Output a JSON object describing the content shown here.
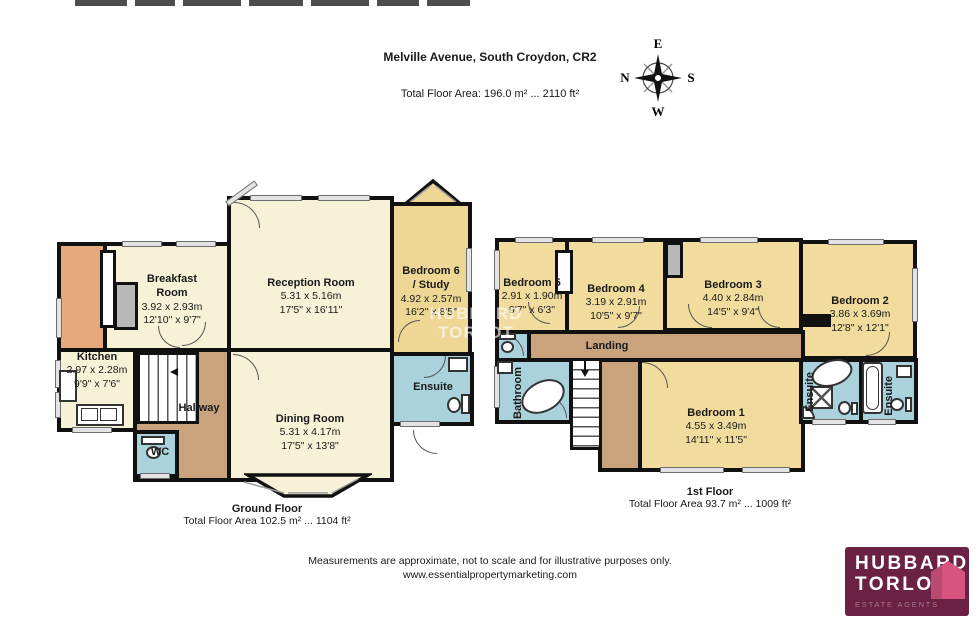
{
  "header": {
    "title": "Melville Avenue, South Croydon, CR2",
    "total_area": "Total Floor Area: 196.0 m² ... 2110 ft²"
  },
  "compass": {
    "top": "E",
    "left": "N",
    "right": "S",
    "bottom": "W"
  },
  "watermark": {
    "line1": "HUBBARD",
    "line2": "TORLOT"
  },
  "ground_floor": {
    "title": "Ground Floor",
    "area": "Total Floor Area 102.5 m² ... 1104 ft²",
    "rooms": {
      "breakfast": {
        "name": "Breakfast Room",
        "metric": "3.92 x 2.93m",
        "imperial": "12'10\" x 9'7\""
      },
      "reception": {
        "name": "Reception Room",
        "metric": "5.31 x 5.16m",
        "imperial": "17'5\" x 16'11\""
      },
      "bedroom6": {
        "name": "Bedroom 6",
        "name2": "/ Study",
        "metric": "4.92 x 2.57m",
        "imperial": "16'2\" x 8'5\""
      },
      "kitchen": {
        "name": "Kitchen",
        "metric": "2.97 x 2.28m",
        "imperial": "9'9\" x 7'6\""
      },
      "dining": {
        "name": "Dining Room",
        "metric": "5.31 x 4.17m",
        "imperial": "17'5\" x 13'8\""
      },
      "hallway": {
        "name": "Hallway"
      },
      "wc": {
        "name": "WC"
      },
      "ensuite": {
        "name": "Ensuite"
      }
    }
  },
  "first_floor": {
    "title": "1st Floor",
    "area": "Total Floor Area 93.7 m² ... 1009 ft²",
    "rooms": {
      "bedroom1": {
        "name": "Bedroom 1",
        "metric": "4.55 x 3.49m",
        "imperial": "14'11\" x 11'5\""
      },
      "bedroom2": {
        "name": "Bedroom 2",
        "metric": "3.86 x 3.69m",
        "imperial": "12'8\" x 12'1\""
      },
      "bedroom3": {
        "name": "Bedroom 3",
        "metric": "4.40 x 2.84m",
        "imperial": "14'5\" x 9'4\""
      },
      "bedroom4": {
        "name": "Bedroom 4",
        "metric": "3.19 x 2.91m",
        "imperial": "10'5\" x 9'7\""
      },
      "bedroom5": {
        "name": "Bedroom 5",
        "metric": "2.91 x 1.90m",
        "imperial": "9'7\" x 6'3\""
      },
      "landing": {
        "name": "Landing"
      },
      "bathroom": {
        "name": "Bathroom"
      },
      "ensuite_front": {
        "name": "Ensuite"
      },
      "ensuite_back": {
        "name": "Ensuite"
      }
    }
  },
  "footer": {
    "disclaimer": "Measurements are approximate, not to scale and for illustrative purposes only.",
    "website": "www.essentialpropertymarketing.com"
  },
  "logo": {
    "name_line1": "HUBBARD",
    "name_line2": "TORLOT",
    "tagline": "ESTATE AGENTS"
  },
  "colors": {
    "room_cream": "#f6f1d7",
    "room_gold": "#f1dc9d",
    "hall_brown": "#c8a37c",
    "bath_blue": "#a9d2dc",
    "utility_orange": "#e8a87e",
    "wall": "#111111",
    "logo_bg": "#6b2143",
    "logo_house": "#d6547f"
  }
}
